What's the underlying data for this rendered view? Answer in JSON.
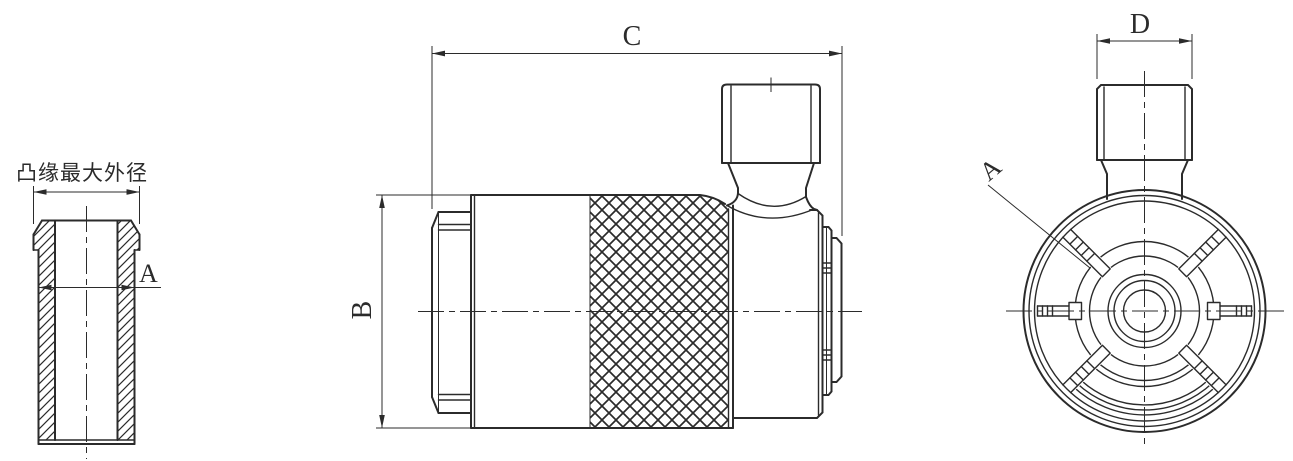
{
  "drawing": {
    "background": "#ffffff",
    "line_color": "#2b2b2b",
    "views": {
      "left_section_view": {
        "flange_note": "凸缘最大外径",
        "bore_dim": "A"
      },
      "front_view": {
        "height_dim": "B",
        "length_dim": "C"
      },
      "end_view": {
        "thread_dim": "D",
        "detail_label": "A"
      }
    }
  }
}
